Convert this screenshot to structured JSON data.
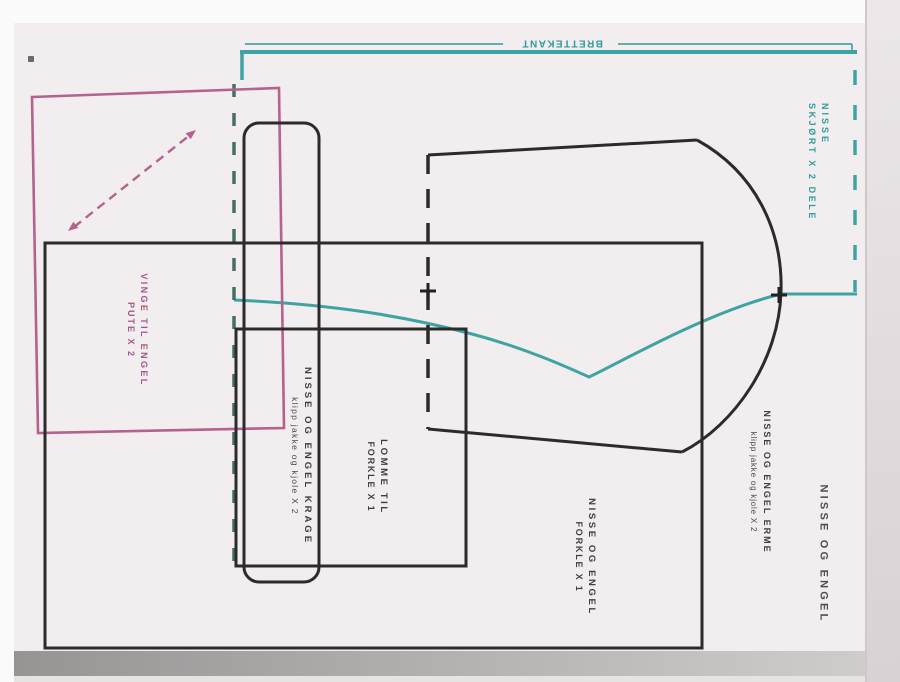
{
  "fold_edge": {
    "label": "BRETTEKANT"
  },
  "pieces": {
    "skirt": {
      "line1": "NISSE",
      "line2": "SKJØRT X 2 DELE"
    },
    "wing": {
      "line1": "VINGE TIL ENGEL",
      "line2": "PUTE X 2"
    },
    "collar": {
      "line1": "NISSE OG ENGEL KRAGE",
      "line2": "klipp jakke og kjole X 2"
    },
    "pocket": {
      "line1": "LOMME TIL",
      "line2": "FORKLE X 1"
    },
    "apron": {
      "line1": "NISSE OG ENGEL",
      "line2": "FORKLE X 1"
    },
    "sleeve": {
      "line1": "NISSE OG ENGEL ERME",
      "line2": "klipp jakke og kjole X 2"
    },
    "title": "NISSE OG ENGEL"
  },
  "colors": {
    "teal": "#3fa3a3",
    "pink": "#b4628e",
    "ink": "#2b2b2b"
  }
}
